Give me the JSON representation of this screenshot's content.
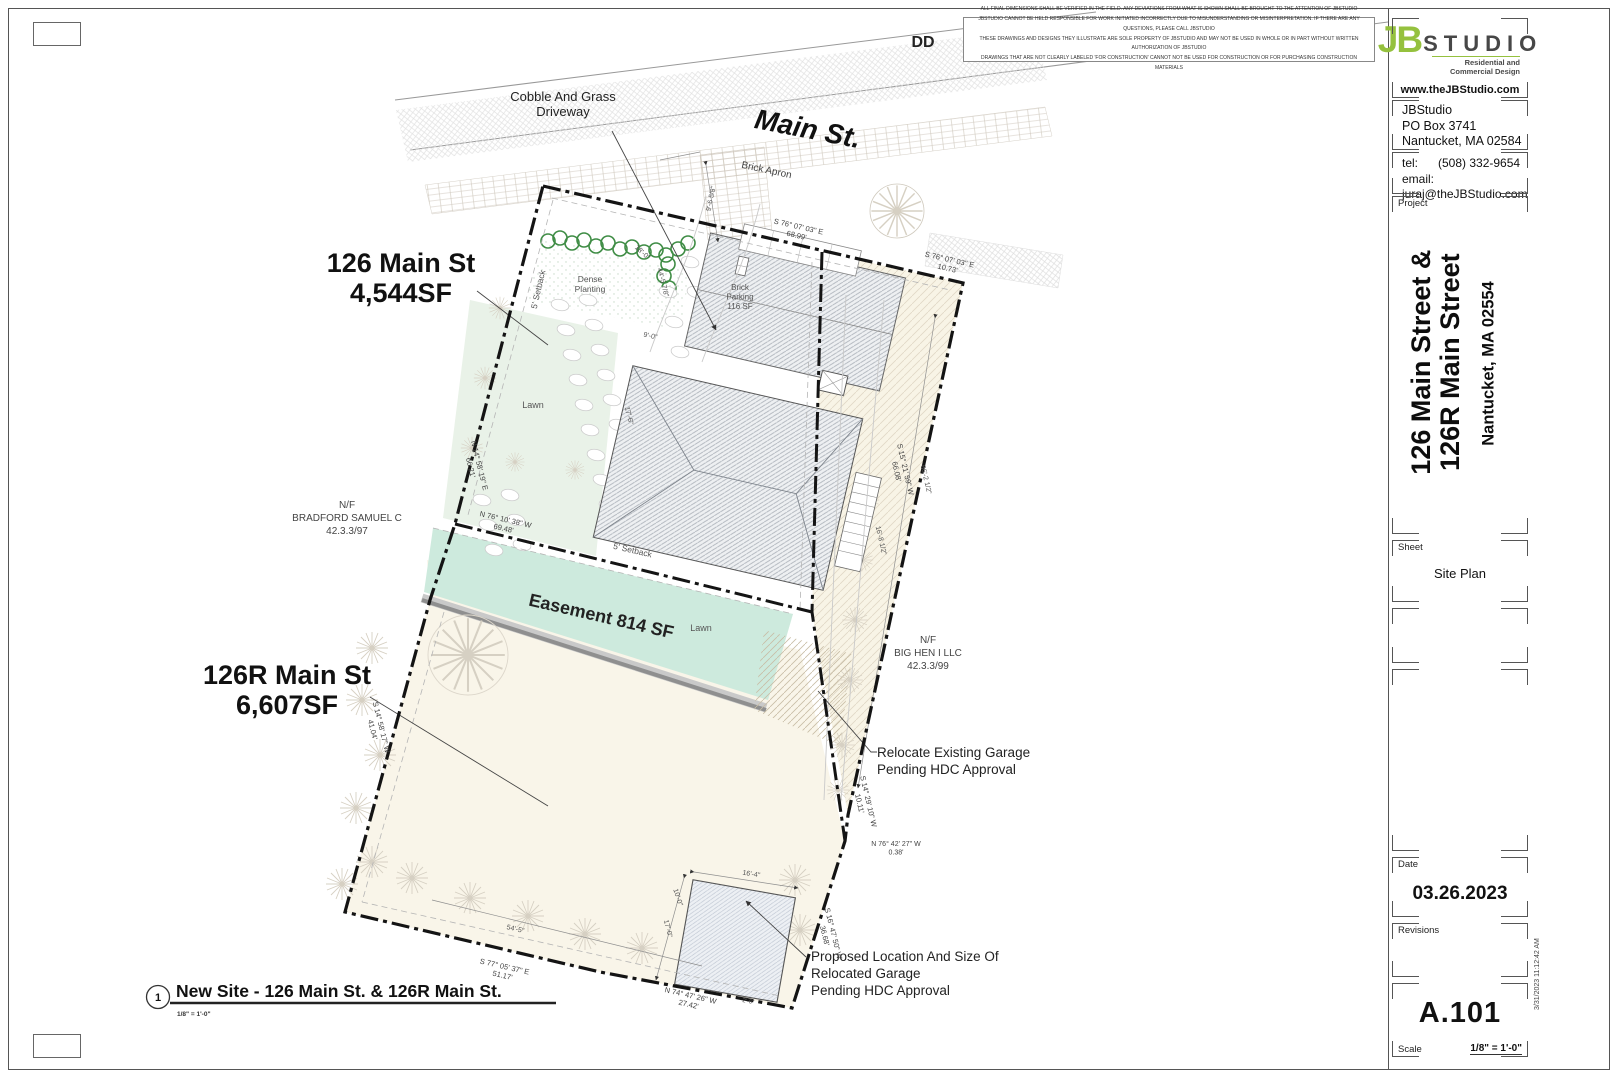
{
  "sheet": {
    "disclaimer_lines": [
      "ALL FINAL DIMENSIONS SHALL BE VERIFIED IN THE FIELD. ANY DEVIATIONS FROM WHAT IS SHOWN SHALL BE BROUGHT TO THE ATTENTION OF JBSTUDIO",
      "JBSTUDIO CANNOT BE HELD RESPONSIBLE FOR WORK INITIATED INCORRECTLY DUE TO MISUNDERSTANDING OR MISINTERPRETATION. IF THERE ARE ANY QUESTIONS, PLEASE CALL JBSTUDIO",
      "THESE DRAWINGS AND DESIGNS THEY ILLUSTRATE ARE SOLE PROPERTY OF JBSTUDIO AND MAY NOT BE USED IN WHOLE OR IN PART WITHOUT WRITTEN AUTHORIZATION OF JBSTUDIO",
      "DRAWINGS THAT ARE NOT CLEARLY LABELED 'FOR CONSTRUCTION' CANNOT NOT BE USED FOR CONSTRUCTION OR FOR PURCHASING CONSTRUCTION MATERIALS"
    ]
  },
  "titleblock": {
    "logo": {
      "jb": "JB",
      "studio": "STUDIO",
      "tagline": "Residential and Commercial Design",
      "url": "www.theJBStudio.com"
    },
    "firm": {
      "name": "JBStudio",
      "po": "PO Box 3741",
      "city": "Nantucket, MA 02584",
      "tel_label": "tel:",
      "tel": "(508) 332-9654",
      "email_label": "email:",
      "email": "juraj@theJBStudio.com"
    },
    "project_label": "Project",
    "project_title_line1": "126 Main Street &",
    "project_title_line2": "126R Main Street",
    "project_city": "Nantucket, MA 02554",
    "sheet_label": "Sheet",
    "sheet_name": "Site Plan",
    "date_label": "Date",
    "date": "03.26.2023",
    "revisions_label": "Revisions",
    "sheet_number": "A.101",
    "scale_label": "Scale",
    "scale": "1/8\" = 1'-0\"",
    "plot_stamp": "3/31/2023 11:12:42 AM"
  },
  "plan": {
    "accent_colors": {
      "easement_mint": "#cdeadd",
      "lawn_green": "#e9f2e8",
      "field_ivory": "#f9f5e9",
      "hedge_green": "#3e8c44",
      "logo_green": "#95c13e"
    },
    "labels": [
      {
        "n": "label-dd",
        "t": [
          "DD"
        ],
        "x": 923,
        "y": 47,
        "s": 16,
        "w": 700,
        "c": "#222"
      },
      {
        "n": "label-main-st",
        "t": [
          "Main St."
        ],
        "x": 806,
        "y": 138,
        "r": 11,
        "s": 28,
        "w": 700,
        "i": 1,
        "c": "#111"
      },
      {
        "n": "note-cobble-driveway",
        "t": [
          "Cobble And Grass",
          "Driveway"
        ],
        "x": 563,
        "y": 101,
        "s": 13,
        "c": "#222",
        "lh": 1.15
      },
      {
        "n": "label-brick-apron",
        "t": [
          "Brick Apron"
        ],
        "x": 766,
        "y": 173,
        "r": 12,
        "s": 10,
        "c": "#444"
      },
      {
        "n": "label-lot-126",
        "t": [
          "126 Main St",
          "4,544SF"
        ],
        "x": 401,
        "y": 272,
        "s": 27,
        "w": 800,
        "c": "#111",
        "lh": 1.12
      },
      {
        "n": "label-lot-126r",
        "t": [
          "126R Main St",
          "6,607SF"
        ],
        "x": 287,
        "y": 684,
        "s": 27,
        "w": 800,
        "c": "#111",
        "lh": 1.12
      },
      {
        "n": "label-easement",
        "t": [
          "Easement 814 SF"
        ],
        "x": 600,
        "y": 622,
        "r": 13,
        "s": 18,
        "w": 700,
        "c": "#222"
      },
      {
        "n": "label-lawn-1",
        "t": [
          "Lawn"
        ],
        "x": 533,
        "y": 408,
        "s": 9,
        "c": "#555"
      },
      {
        "n": "label-lawn-2",
        "t": [
          "Lawn"
        ],
        "x": 701,
        "y": 631,
        "s": 9,
        "c": "#555"
      },
      {
        "n": "label-dense-planting",
        "t": [
          "Dense",
          "Planting"
        ],
        "x": 590,
        "y": 282,
        "s": 8.5,
        "c": "#555",
        "lh": 1.2
      },
      {
        "n": "label-brick-parking",
        "t": [
          "Brick",
          "Parking",
          "116 SF"
        ],
        "x": 740,
        "y": 290,
        "s": 8,
        "c": "#555",
        "lh": 1.2
      },
      {
        "n": "label-setback-1",
        "t": [
          "5' Setback"
        ],
        "x": 541,
        "y": 290,
        "r": -77,
        "s": 8.5,
        "c": "#555"
      },
      {
        "n": "label-setback-2",
        "t": [
          "5' Setback"
        ],
        "x": 632,
        "y": 553,
        "r": 13,
        "s": 8.5,
        "c": "#555"
      },
      {
        "n": "label-abutter-bradford",
        "t": [
          "N/F",
          "BRADFORD SAMUEL C",
          "42.3.3/97"
        ],
        "x": 347,
        "y": 508,
        "s": 10,
        "c": "#444",
        "lh": 1.3
      },
      {
        "n": "label-abutter-bighen",
        "t": [
          "N/F",
          "BIG HEN I LLC",
          "42.3.3/99"
        ],
        "x": 928,
        "y": 643,
        "s": 10,
        "c": "#444",
        "lh": 1.3
      },
      {
        "n": "note-relocate-garage",
        "t": [
          "Relocate Existing Garage",
          "Pending HDC Approval"
        ],
        "x": 877,
        "y": 757,
        "s": 13.5,
        "a": "s",
        "c": "#222",
        "lh": 1.25
      },
      {
        "n": "note-proposed-garage",
        "t": [
          "Proposed Location And Size Of",
          "Relocated Garage",
          "Pending HDC Approval"
        ],
        "x": 811,
        "y": 961,
        "s": 13.5,
        "a": "s",
        "c": "#222",
        "lh": 1.25
      },
      {
        "n": "drawing-title",
        "t": [
          "New Site - 126 Main St. & 126R Main St."
        ],
        "x": 176,
        "y": 997,
        "s": 17.5,
        "w": 800,
        "a": "s",
        "c": "#111"
      },
      {
        "n": "drawing-scale",
        "t": [
          "1/8\" = 1'-0\""
        ],
        "x": 177,
        "y": 1016,
        "s": 6.5,
        "w": 700,
        "a": "s",
        "c": "#333"
      },
      {
        "n": "drawing-number-bubble-text",
        "t": [
          "1"
        ],
        "x": 158,
        "y": 1001,
        "s": 11,
        "w": 700,
        "c": "#111"
      },
      {
        "n": "bearing-top-1",
        "t": [
          "S 76° 07' 03\" E",
          "68.99'"
        ],
        "x": 798,
        "y": 229,
        "r": 13,
        "s": 7.5,
        "c": "#444",
        "lh": 1.2
      },
      {
        "n": "bearing-top-2",
        "t": [
          "S 76° 07' 03\" E",
          "10.73'"
        ],
        "x": 949,
        "y": 262,
        "r": 13,
        "s": 7.5,
        "c": "#444",
        "lh": 1.2
      },
      {
        "n": "bearing-east-1",
        "t": [
          "S 15° 21' 59\" W",
          "66.08'"
        ],
        "x": 903,
        "y": 470,
        "r": 77,
        "s": 7.5,
        "c": "#444",
        "lh": 1.2
      },
      {
        "n": "bearing-east-2",
        "t": [
          "S 14° 29' 10\" W",
          "10.11'"
        ],
        "x": 866,
        "y": 802,
        "r": 77,
        "s": 7.5,
        "c": "#444",
        "lh": 1.2
      },
      {
        "n": "bearing-east-3",
        "t": [
          "N 76° 42' 27\" W",
          "0.38'"
        ],
        "x": 896,
        "y": 846,
        "s": 7,
        "c": "#444",
        "lh": 1.2
      },
      {
        "n": "bearing-east-4",
        "t": [
          "S 16° 47' 50\" W",
          "36.68'"
        ],
        "x": 831,
        "y": 934,
        "r": 76,
        "s": 7.5,
        "c": "#444",
        "lh": 1.2
      },
      {
        "n": "bearing-west-1",
        "t": [
          "N 14° 58' 19\" E",
          "66.21'"
        ],
        "x": 477,
        "y": 466,
        "r": 76,
        "s": 7.5,
        "c": "#444",
        "lh": 1.2
      },
      {
        "n": "bearing-mid-1",
        "t": [
          "N 76° 10' 38\" W",
          "69.48'"
        ],
        "x": 505,
        "y": 522,
        "r": 13,
        "s": 7.5,
        "c": "#444",
        "lh": 1.2
      },
      {
        "n": "bearing-west-2",
        "t": [
          "S 14° 58' 17\" W",
          "41.04'"
        ],
        "x": 379,
        "y": 728,
        "r": 76,
        "s": 7.5,
        "c": "#444",
        "lh": 1.2
      },
      {
        "n": "bearing-south-1",
        "t": [
          "S 77° 05' 37\" E",
          "51.17'"
        ],
        "x": 504,
        "y": 969,
        "r": 13,
        "s": 7.5,
        "c": "#444",
        "lh": 1.2
      },
      {
        "n": "bearing-south-2",
        "t": [
          "N 74° 47' 26\" W",
          "27.42'"
        ],
        "x": 690,
        "y": 998,
        "r": 13,
        "s": 7.5,
        "c": "#444",
        "lh": 1.2
      },
      {
        "n": "dim-apron",
        "t": [
          "9'-6 5/8\""
        ],
        "x": 713,
        "y": 199,
        "r": -78,
        "s": 7,
        "c": "#555"
      },
      {
        "n": "dim-strip-length",
        "t": [
          "66'-2 1/2\""
        ],
        "x": 924,
        "y": 480,
        "r": 77,
        "s": 7,
        "c": "#555"
      },
      {
        "n": "dim-strip-width",
        "t": [
          "16'-8 1/2\""
        ],
        "x": 879,
        "y": 541,
        "r": 77,
        "s": 7,
        "c": "#555"
      },
      {
        "n": "dim-garage-width",
        "t": [
          "16'-4\""
        ],
        "x": 751,
        "y": 876,
        "r": 9,
        "s": 7,
        "c": "#555"
      },
      {
        "n": "dim-garage-depth",
        "t": [
          "17'-0\""
        ],
        "x": 666,
        "y": 929,
        "r": 76,
        "s": 7,
        "c": "#555"
      },
      {
        "n": "dim-rear-yard",
        "t": [
          "54'-5\""
        ],
        "x": 515,
        "y": 931,
        "r": 13,
        "s": 7,
        "c": "#555"
      },
      {
        "n": "dim-driveway",
        "t": [
          "18'-0\""
        ],
        "x": 641,
        "y": 254,
        "r": 42,
        "s": 7,
        "c": "#555"
      },
      {
        "n": "dim-planting",
        "t": [
          "44'-5 7/8\""
        ],
        "x": 661,
        "y": 283,
        "r": 76,
        "s": 7,
        "c": "#555"
      },
      {
        "n": "dim-parking",
        "t": [
          "17'-6\""
        ],
        "x": 627,
        "y": 416,
        "r": 76,
        "s": 7,
        "c": "#555"
      },
      {
        "n": "dim-garage-offset",
        "t": [
          "10'-0\""
        ],
        "x": 676,
        "y": 898,
        "r": 72,
        "s": 7,
        "c": "#555"
      },
      {
        "n": "dim-corner",
        "t": [
          "2'-6\""
        ],
        "x": 748,
        "y": 1003,
        "r": 10,
        "s": 6,
        "c": "#555"
      },
      {
        "n": "dim-drive-width",
        "t": [
          "9'-0\""
        ],
        "x": 650,
        "y": 338,
        "r": 12,
        "s": 7,
        "c": "#555"
      }
    ]
  }
}
